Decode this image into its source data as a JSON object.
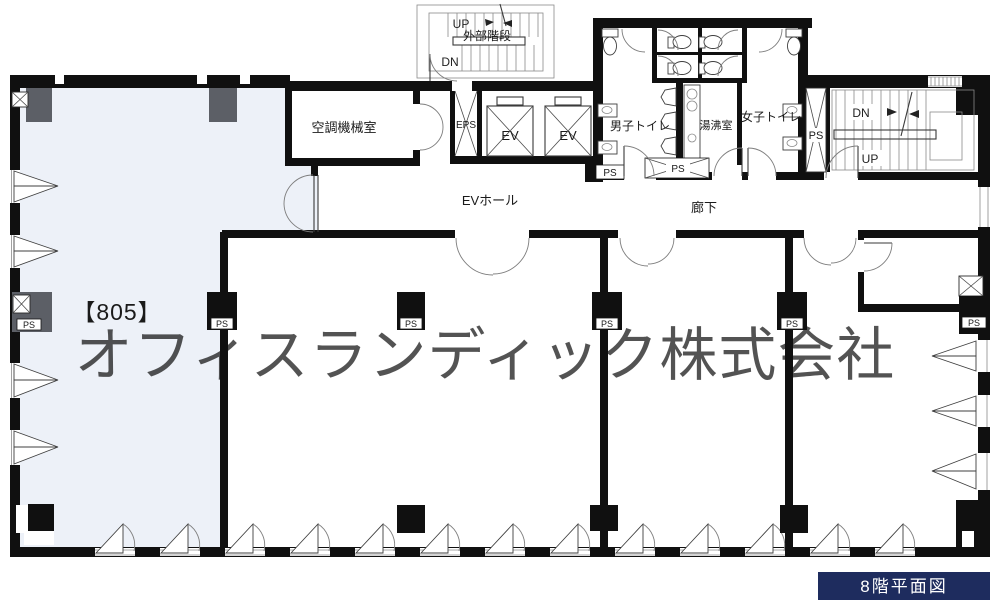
{
  "title_box": {
    "label": "8階平面図",
    "bg": "#1e2c5e"
  },
  "watermark": {
    "text": "オフィスランディック株式会社",
    "color": "#dcdde2"
  },
  "unit": {
    "label": "【805】",
    "fill": "#edf1f8"
  },
  "rooms": {
    "machine_room": "空調機械室",
    "ev_hall": "EVホール",
    "corridor": "廊下",
    "mens_toilet": "男子トイレ",
    "pantry": "湯沸室",
    "womens_toilet": "女子トイレ",
    "external_stair": "外部階段"
  },
  "shafts": {
    "eps": "EPS",
    "ev": "EV",
    "ps": "PS"
  },
  "directions": {
    "up": "UP",
    "down": "DN"
  },
  "colors": {
    "wall": "#101010",
    "column_gray": "#5c5f66"
  }
}
